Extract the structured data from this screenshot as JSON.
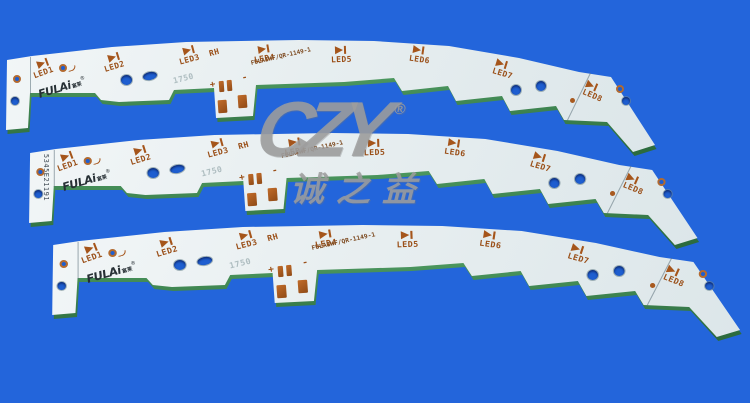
{
  "photo": {
    "background_color": "#2365db",
    "board_surface_color": "#e9eff1",
    "board_edge_color": "#3e8f54",
    "copper_color": "#a5551b",
    "watermark": {
      "logo": "CZY",
      "registered": "®",
      "chinese": "诚之益",
      "color": "#9e9e9e"
    },
    "boards": [
      {
        "id": "top",
        "brand": "FULAi",
        "brand_cn": "富莱",
        "brand_reg": "®",
        "serial": "",
        "leds": [
          "LED1",
          "LED2",
          "LED3",
          "LED4",
          "LED5",
          "LED6",
          "LED7",
          "LED8"
        ],
        "marks": {
          "rh": "RH",
          "code": "1750",
          "plus": "+",
          "minus": "-",
          "part_number": "FULAIWF/QR-1149-1"
        }
      },
      {
        "id": "middle",
        "brand": "FULAi",
        "brand_cn": "富莱",
        "brand_reg": "®",
        "serial": "5345E21191",
        "leds": [
          "LED1",
          "LED2",
          "LED3",
          "LED4",
          "LED5",
          "LED6",
          "LED7",
          "LED8"
        ],
        "marks": {
          "rh": "RH",
          "code": "1750",
          "plus": "+",
          "minus": "-",
          "part_number": "FULAIWF/QR-1149-1"
        }
      },
      {
        "id": "bottom",
        "brand": "FULAi",
        "brand_cn": "富莱",
        "brand_reg": "®",
        "serial": "",
        "leds": [
          "LED1",
          "LED2",
          "LED3",
          "LED4",
          "LED5",
          "LED6",
          "LED7",
          "LED8"
        ],
        "marks": {
          "rh": "RH",
          "code": "1750",
          "plus": "+",
          "minus": "-",
          "part_number": "FULAIWF/QR-1149-1"
        }
      }
    ]
  }
}
